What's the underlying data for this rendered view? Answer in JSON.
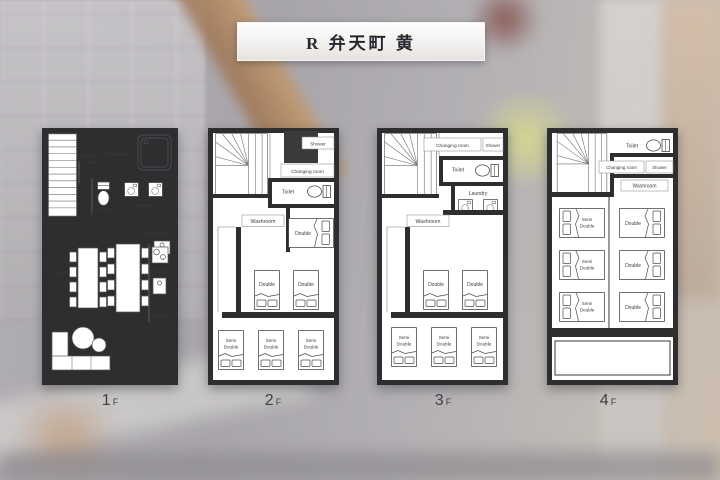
{
  "title": "R 弁天町 黄",
  "floors": [
    {
      "caption_num": "1",
      "caption_suffix": "F",
      "labels": {
        "changing_line1": "Changing",
        "changing_line2": "room",
        "bathroom": "Bathroom",
        "toilet": "Toilet",
        "laundry": "Laundry",
        "washroom": "Washroom",
        "tv": "TV",
        "kitchen": "Kitchen",
        "refrigerator": "Refrigerator"
      },
      "bed_summary": {
        "double": 0,
        "semi_double": 0
      }
    },
    {
      "caption_num": "2",
      "caption_suffix": "F",
      "labels": {
        "shower": "Shower",
        "changing_room": "Changing room",
        "toilet": "Toilet",
        "washroom": "Washroom"
      },
      "bed_summary": {
        "double": 3,
        "semi_double": 3
      }
    },
    {
      "caption_num": "3",
      "caption_suffix": "F",
      "labels": {
        "changing_room": "Changing room",
        "shower": "Shower",
        "toilet": "Toilet",
        "laundry": "Laundry",
        "washroom": "Washroom"
      },
      "bed_summary": {
        "double": 2,
        "semi_double": 3
      }
    },
    {
      "caption_num": "4",
      "caption_suffix": "F",
      "labels": {
        "toilet": "Toilet",
        "changing_room": "Changing room",
        "shower": "Shower",
        "washroom": "Washroom"
      },
      "bed_summary": {
        "double": 3,
        "semi_double": 3
      }
    }
  ],
  "bed_labels": {
    "double": "Double",
    "semi_line1": "Semi",
    "semi_line2": "Double"
  },
  "colors": {
    "wall": "#2e2e30",
    "shower_block": "#3a3a3c",
    "banner_text": "#26262e"
  }
}
